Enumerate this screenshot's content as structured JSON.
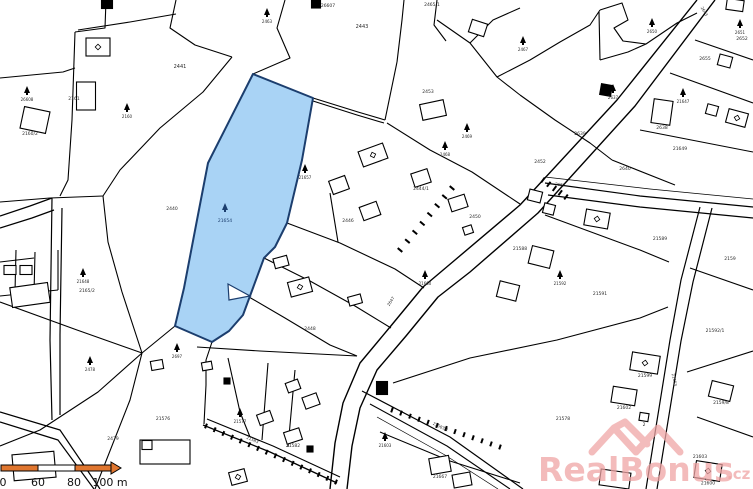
{
  "canvas": {
    "w": 753,
    "h": 489,
    "bg": "#ffffff",
    "line_color": "#000000",
    "label_color": "#2a2a2a"
  },
  "highlight_parcel": {
    "number": "21654",
    "fill": "#a9d3f5",
    "stroke": "#1c3e6e",
    "points": "253,74 313,98 302,160 287,223 275,247 264,258 250,296 243,315 229,331 212,342 175,326 184,288 197,220 208,163 211,157",
    "notch": "228,284 250,296 229,300",
    "tree": {
      "x": 225,
      "y": 205
    },
    "label_pos": {
      "x": 225,
      "y": 222
    }
  },
  "roads": [
    {
      "pts": "697,0 617,100 520,205 455,260 423,287 390,327 360,363 343,403 335,443 330,489",
      "w": 1.4
    },
    {
      "pts": "715,0 635,106 538,213 470,272 438,297 406,336 377,370 360,408 352,446 347,489",
      "w": 1.4
    },
    {
      "pts": "545,183 640,196 753,207",
      "w": 1.2
    },
    {
      "pts": "548,195 640,207 753,218",
      "w": 1.2
    },
    {
      "pts": "545,177 650,189 753,199",
      "w": 0.7
    },
    {
      "pts": "700,207 681,280 670,340 646,489",
      "w": 1.2
    },
    {
      "pts": "712,208 693,282 681,341 657,489",
      "w": 1.2
    },
    {
      "pts": "362,391 450,437 523,489",
      "w": 1.2
    },
    {
      "pts": "370,404 447,446 510,489",
      "w": 1.1
    },
    {
      "pts": "377,417 445,455 498,489",
      "w": 0.7
    },
    {
      "pts": "203,425 270,452 337,483",
      "w": 1.3
    },
    {
      "pts": "207,419 273,446 340,477",
      "w": 1.1
    },
    {
      "pts": "0,216 30,206 52,198",
      "w": 1.2
    },
    {
      "pts": "0,228 32,218 54,210",
      "w": 1.2
    },
    {
      "pts": "52,198 50,340 52,420",
      "w": 1.2
    },
    {
      "pts": "62,208 60,335 60,415",
      "w": 1.2
    },
    {
      "pts": "0,412 60,430 100,489",
      "w": 1.2
    },
    {
      "pts": "0,422 58,440 94,489",
      "w": 1.2
    }
  ],
  "boundaries": [
    "0,78 63,72 75,68",
    "106,0 105,28 75,32",
    "75,32 72,120 68,180 60,196",
    "78,30 130,22 176,14",
    "176,0 170,28 195,45 232,57",
    "232,57 203,92 160,128 120,170 103,196",
    "0,202 50,198 103,196",
    "103,196 108,242 122,292 142,353",
    "0,302 77,330 142,353",
    "142,353 175,326",
    "142,353 130,400 95,489",
    "142,353 98,392 40,430 0,446",
    "197,347 260,351 357,356",
    "285,0 277,28 290,58 253,74",
    "397,62 402,20 404,0",
    "313,98 358,112 385,120",
    "313,101 357,115 384,123",
    "385,120 397,62",
    "387,123 430,150 472,172 520,204",
    "287,223 340,243 395,269 424,288",
    "264,258 310,281 355,306 391,328",
    "249,297 285,318 330,345 357,356",
    "330,193 338,242",
    "437,0 434,25 446,41",
    "437,20 470,43 497,77 520,95",
    "470,43 493,20 520,8",
    "497,77 530,60 560,42 590,25 600,10",
    "600,10 622,3 628,20 614,28 623,41 646,44 677,23 697,13",
    "600,60 628,52 646,44",
    "599,12 600,60",
    "695,40 753,60",
    "670,73 753,103",
    "640,130 753,152",
    "612,160 675,185",
    "520,95 555,120 590,143 612,160",
    "545,215 640,250 669,262",
    "690,268 753,290",
    "393,383 470,358 557,340 640,318 668,307",
    "687,372 753,351",
    "697,417 753,437",
    "380,432 450,461 520,483",
    "228,358 240,412 250,437",
    "268,363 262,440",
    "295,370 288,447",
    "204,424 206,385 206,360",
    "212,342 206,360",
    "16,250 15,292",
    "35,252 34,294",
    "0,296 58,290",
    "58,290 58,250",
    "0,262 34,258"
  ],
  "hatch_sets": [
    {
      "from": [
        452,
        188
      ],
      "to": [
        400,
        250
      ],
      "n": 8,
      "len": 6
    },
    {
      "from": [
        206,
        426
      ],
      "to": [
        336,
        482
      ],
      "n": 16,
      "len": 5
    },
    {
      "from": [
        392,
        410
      ],
      "to": [
        500,
        447
      ],
      "n": 13,
      "len": 5
    },
    {
      "from": [
        543,
        180
      ],
      "to": [
        566,
        197
      ],
      "n": 5,
      "len": 6
    }
  ],
  "buildings": [
    {
      "cx": 107,
      "cy": 4,
      "w": 11,
      "h": 9,
      "rot": 0,
      "fill": "k"
    },
    {
      "cx": 98,
      "cy": 47,
      "w": 24,
      "h": 18,
      "rot": 0,
      "fill": "w",
      "sym": true
    },
    {
      "cx": 86,
      "cy": 96,
      "w": 19,
      "h": 28,
      "rot": 0,
      "fill": "w"
    },
    {
      "cx": 35,
      "cy": 120,
      "w": 26,
      "h": 22,
      "rot": 12,
      "fill": "w"
    },
    {
      "cx": 30,
      "cy": 295,
      "w": 38,
      "h": 20,
      "rot": -8,
      "fill": "w"
    },
    {
      "cx": 10,
      "cy": 270,
      "w": 12,
      "h": 9,
      "rot": 0,
      "fill": "w"
    },
    {
      "cx": 26,
      "cy": 270,
      "w": 12,
      "h": 9,
      "rot": 0,
      "fill": "w"
    },
    {
      "cx": 34,
      "cy": 466,
      "w": 42,
      "h": 26,
      "rot": -5,
      "fill": "w"
    },
    {
      "cx": 165,
      "cy": 452,
      "w": 50,
      "h": 24,
      "rot": 0,
      "fill": "w"
    },
    {
      "cx": 147,
      "cy": 445,
      "w": 10,
      "h": 9,
      "rot": 0,
      "fill": "w"
    },
    {
      "cx": 300,
      "cy": 287,
      "w": 22,
      "h": 15,
      "rot": -15,
      "fill": "w",
      "sym": true
    },
    {
      "cx": 355,
      "cy": 300,
      "w": 13,
      "h": 9,
      "rot": -15,
      "fill": "w"
    },
    {
      "cx": 281,
      "cy": 262,
      "w": 14,
      "h": 10,
      "rot": -15,
      "fill": "w"
    },
    {
      "cx": 339,
      "cy": 185,
      "w": 17,
      "h": 14,
      "rot": -20,
      "fill": "w"
    },
    {
      "cx": 373,
      "cy": 155,
      "w": 26,
      "h": 16,
      "rot": -20,
      "fill": "w",
      "sym": true
    },
    {
      "cx": 370,
      "cy": 211,
      "w": 18,
      "h": 14,
      "rot": -20,
      "fill": "w"
    },
    {
      "cx": 421,
      "cy": 178,
      "w": 17,
      "h": 14,
      "rot": -18,
      "fill": "w",
      "label": "2444/1"
    },
    {
      "cx": 458,
      "cy": 203,
      "w": 17,
      "h": 13,
      "rot": -18,
      "fill": "w"
    },
    {
      "cx": 433,
      "cy": 110,
      "w": 24,
      "h": 16,
      "rot": -12,
      "fill": "w"
    },
    {
      "cx": 478,
      "cy": 28,
      "w": 16,
      "h": 13,
      "rot": 18,
      "fill": "w"
    },
    {
      "cx": 468,
      "cy": 230,
      "w": 9,
      "h": 8,
      "rot": -18,
      "fill": "w"
    },
    {
      "cx": 535,
      "cy": 196,
      "w": 13,
      "h": 11,
      "rot": 14,
      "fill": "w"
    },
    {
      "cx": 549,
      "cy": 209,
      "w": 11,
      "h": 10,
      "rot": 14,
      "fill": "w"
    },
    {
      "cx": 597,
      "cy": 219,
      "w": 24,
      "h": 16,
      "rot": 10,
      "fill": "w",
      "sym": true
    },
    {
      "cx": 541,
      "cy": 257,
      "w": 22,
      "h": 18,
      "rot": 14,
      "fill": "w"
    },
    {
      "cx": 508,
      "cy": 291,
      "w": 20,
      "h": 16,
      "rot": 14,
      "fill": "w"
    },
    {
      "cx": 645,
      "cy": 363,
      "w": 28,
      "h": 18,
      "rot": 9,
      "fill": "w",
      "sym": true,
      "label": "21599"
    },
    {
      "cx": 624,
      "cy": 396,
      "w": 24,
      "h": 16,
      "rot": 9,
      "fill": "w",
      "label": "21602"
    },
    {
      "cx": 644,
      "cy": 417,
      "w": 9,
      "h": 8,
      "rot": 9,
      "fill": "w",
      "label": "2"
    },
    {
      "cx": 721,
      "cy": 391,
      "w": 22,
      "h": 16,
      "rot": 14,
      "fill": "w",
      "label": "2159/8"
    },
    {
      "cx": 708,
      "cy": 471,
      "w": 26,
      "h": 17,
      "rot": 9,
      "fill": "w",
      "sym": true,
      "label": "21600"
    },
    {
      "cx": 440,
      "cy": 465,
      "w": 20,
      "h": 16,
      "rot": -10,
      "fill": "w",
      "label": "21667"
    },
    {
      "cx": 462,
      "cy": 480,
      "w": 18,
      "h": 13,
      "rot": -10,
      "fill": "w"
    },
    {
      "cx": 735,
      "cy": 5,
      "w": 17,
      "h": 11,
      "rot": 8,
      "fill": "w"
    },
    {
      "cx": 725,
      "cy": 61,
      "w": 13,
      "h": 11,
      "rot": 15,
      "fill": "w"
    },
    {
      "cx": 712,
      "cy": 110,
      "w": 11,
      "h": 10,
      "rot": 15,
      "fill": "w"
    },
    {
      "cx": 737,
      "cy": 118,
      "w": 20,
      "h": 14,
      "rot": 15,
      "fill": "w",
      "sym": true
    },
    {
      "cx": 662,
      "cy": 112,
      "w": 19,
      "h": 24,
      "rot": 8,
      "fill": "w",
      "label": "2638"
    },
    {
      "cx": 606,
      "cy": 90,
      "w": 11,
      "h": 11,
      "rot": 10,
      "fill": "k"
    },
    {
      "cx": 265,
      "cy": 418,
      "w": 14,
      "h": 11,
      "rot": -20,
      "fill": "w"
    },
    {
      "cx": 293,
      "cy": 386,
      "w": 13,
      "h": 10,
      "rot": -20,
      "fill": "w"
    },
    {
      "cx": 311,
      "cy": 401,
      "w": 15,
      "h": 12,
      "rot": -20,
      "fill": "w"
    },
    {
      "cx": 293,
      "cy": 436,
      "w": 16,
      "h": 12,
      "rot": -18,
      "fill": "w",
      "label": "21582"
    },
    {
      "cx": 238,
      "cy": 477,
      "w": 16,
      "h": 13,
      "rot": -15,
      "fill": "w",
      "sym": true
    },
    {
      "cx": 382,
      "cy": 388,
      "w": 11,
      "h": 13,
      "rot": 0,
      "fill": "k"
    },
    {
      "cx": 310,
      "cy": 449,
      "w": 6,
      "h": 6,
      "rot": 0,
      "fill": "k"
    },
    {
      "cx": 227,
      "cy": 381,
      "w": 6,
      "h": 6,
      "rot": 0,
      "fill": "k"
    },
    {
      "cx": 316,
      "cy": 4,
      "w": 9,
      "h": 8,
      "rot": 0,
      "fill": "k"
    },
    {
      "cx": 157,
      "cy": 365,
      "w": 12,
      "h": 9,
      "rot": -10,
      "fill": "w"
    },
    {
      "cx": 207,
      "cy": 366,
      "w": 10,
      "h": 8,
      "rot": -10,
      "fill": "w"
    },
    {
      "cx": 615,
      "cy": 479,
      "w": 30,
      "h": 16,
      "rot": 8,
      "fill": "w"
    }
  ],
  "trees": [
    {
      "x": 27,
      "y": 88,
      "label": "26608"
    },
    {
      "x": 127,
      "y": 105,
      "label": "2160"
    },
    {
      "x": 267,
      "y": 10,
      "label": "2463"
    },
    {
      "x": 305,
      "y": 166,
      "label": "21657"
    },
    {
      "x": 90,
      "y": 358,
      "label": "2478"
    },
    {
      "x": 83,
      "y": 270,
      "label": "21648"
    },
    {
      "x": 445,
      "y": 143,
      "label": "2468"
    },
    {
      "x": 467,
      "y": 125,
      "label": "2469"
    },
    {
      "x": 652,
      "y": 20,
      "label": "2650"
    },
    {
      "x": 740,
      "y": 21,
      "label": "2651"
    },
    {
      "x": 683,
      "y": 90,
      "label": "21647"
    },
    {
      "x": 523,
      "y": 38,
      "label": "2467"
    },
    {
      "x": 177,
      "y": 345,
      "label": "2697"
    },
    {
      "x": 240,
      "y": 410,
      "label": "21577"
    },
    {
      "x": 425,
      "y": 272,
      "label": "21660"
    },
    {
      "x": 560,
      "y": 272,
      "label": "21592"
    },
    {
      "x": 613,
      "y": 86,
      "label": "2637"
    },
    {
      "x": 385,
      "y": 434,
      "label": "21603"
    }
  ],
  "labels": [
    {
      "x": 180,
      "y": 68,
      "t": "2441",
      "s": 5
    },
    {
      "x": 362,
      "y": 28,
      "t": "2443",
      "s": 5
    },
    {
      "x": 432,
      "y": 6,
      "t": "2465/1",
      "s": 4.5
    },
    {
      "x": 328,
      "y": 7,
      "t": "26607",
      "s": 4.5
    },
    {
      "x": 87,
      "y": 292,
      "t": "2165/2",
      "s": 4.5
    },
    {
      "x": 74,
      "y": 100,
      "t": "2161",
      "s": 4.5
    },
    {
      "x": 30,
      "y": 135,
      "t": "2160/2",
      "s": 4.5
    },
    {
      "x": 163,
      "y": 420,
      "t": "21576",
      "s": 4.5
    },
    {
      "x": 563,
      "y": 420,
      "t": "21578",
      "s": 4.5
    },
    {
      "x": 600,
      "y": 295,
      "t": "21591",
      "s": 4.5
    },
    {
      "x": 715,
      "y": 332,
      "t": "21592/1",
      "s": 4.5
    },
    {
      "x": 475,
      "y": 218,
      "t": "2450",
      "s": 4.5
    },
    {
      "x": 540,
      "y": 163,
      "t": "2452",
      "s": 4.5
    },
    {
      "x": 428,
      "y": 93,
      "t": "2453",
      "s": 4.5
    },
    {
      "x": 520,
      "y": 250,
      "t": "21588",
      "s": 4.5
    },
    {
      "x": 700,
      "y": 458,
      "t": "21603",
      "s": 4.5
    },
    {
      "x": 660,
      "y": 240,
      "t": "21589",
      "s": 4.5
    },
    {
      "x": 730,
      "y": 260,
      "t": "2159",
      "s": 4.5
    },
    {
      "x": 705,
      "y": 60,
      "t": "2655",
      "s": 4.5
    },
    {
      "x": 742,
      "y": 40,
      "t": "2652",
      "s": 4.5
    },
    {
      "x": 625,
      "y": 170,
      "t": "2640",
      "s": 4.5
    },
    {
      "x": 580,
      "y": 135,
      "t": "2639",
      "s": 4.5
    },
    {
      "x": 680,
      "y": 150,
      "t": "21649",
      "s": 4.5
    },
    {
      "x": 310,
      "y": 330,
      "t": "2448",
      "s": 4.5
    },
    {
      "x": 348,
      "y": 222,
      "t": "2446",
      "s": 4.5
    },
    {
      "x": 172,
      "y": 210,
      "t": "2440",
      "s": 4.5
    },
    {
      "x": 113,
      "y": 440,
      "t": "2479",
      "s": 4.5
    }
  ],
  "road_labels": [
    {
      "x": 703,
      "y": 12,
      "t": "2643",
      "rot": 60
    },
    {
      "x": 560,
      "y": 186,
      "t": "2657",
      "rot": 8
    },
    {
      "x": 673,
      "y": 380,
      "t": "21653",
      "rot": 78
    },
    {
      "x": 392,
      "y": 302,
      "t": "2647",
      "rot": -58
    },
    {
      "x": 252,
      "y": 441,
      "t": "21583",
      "rot": 23
    },
    {
      "x": 440,
      "y": 428,
      "t": "21583/1",
      "rot": 25
    }
  ],
  "scalebar": {
    "y": 465,
    "h": 6,
    "border": "#000000",
    "orange": "#e0762f",
    "white": "#ffffff",
    "segments": [
      {
        "x": 1,
        "w": 37,
        "c": "orange"
      },
      {
        "x": 38,
        "w": 37,
        "c": "white"
      },
      {
        "x": 75,
        "w": 36,
        "c": "orange"
      }
    ],
    "arrow_x": 111,
    "labels": [
      {
        "t": "0",
        "x": 3
      },
      {
        "t": "60",
        "x": 38
      },
      {
        "t": "80",
        "x": 74
      },
      {
        "t": "100 m",
        "x": 110
      }
    ],
    "label_y": 486,
    "font_size": 11
  },
  "watermark": {
    "text": "RealBonus",
    "suffix": ".cz",
    "color": "#efa5a5",
    "opacity": 0.75,
    "text_x": 538,
    "text_y": 481,
    "font_size": 33,
    "suffix_x": 727,
    "suffix_y": 479,
    "suffix_size": 15,
    "logo": {
      "x": 592,
      "y": 452,
      "w": 88,
      "h": 30
    }
  }
}
